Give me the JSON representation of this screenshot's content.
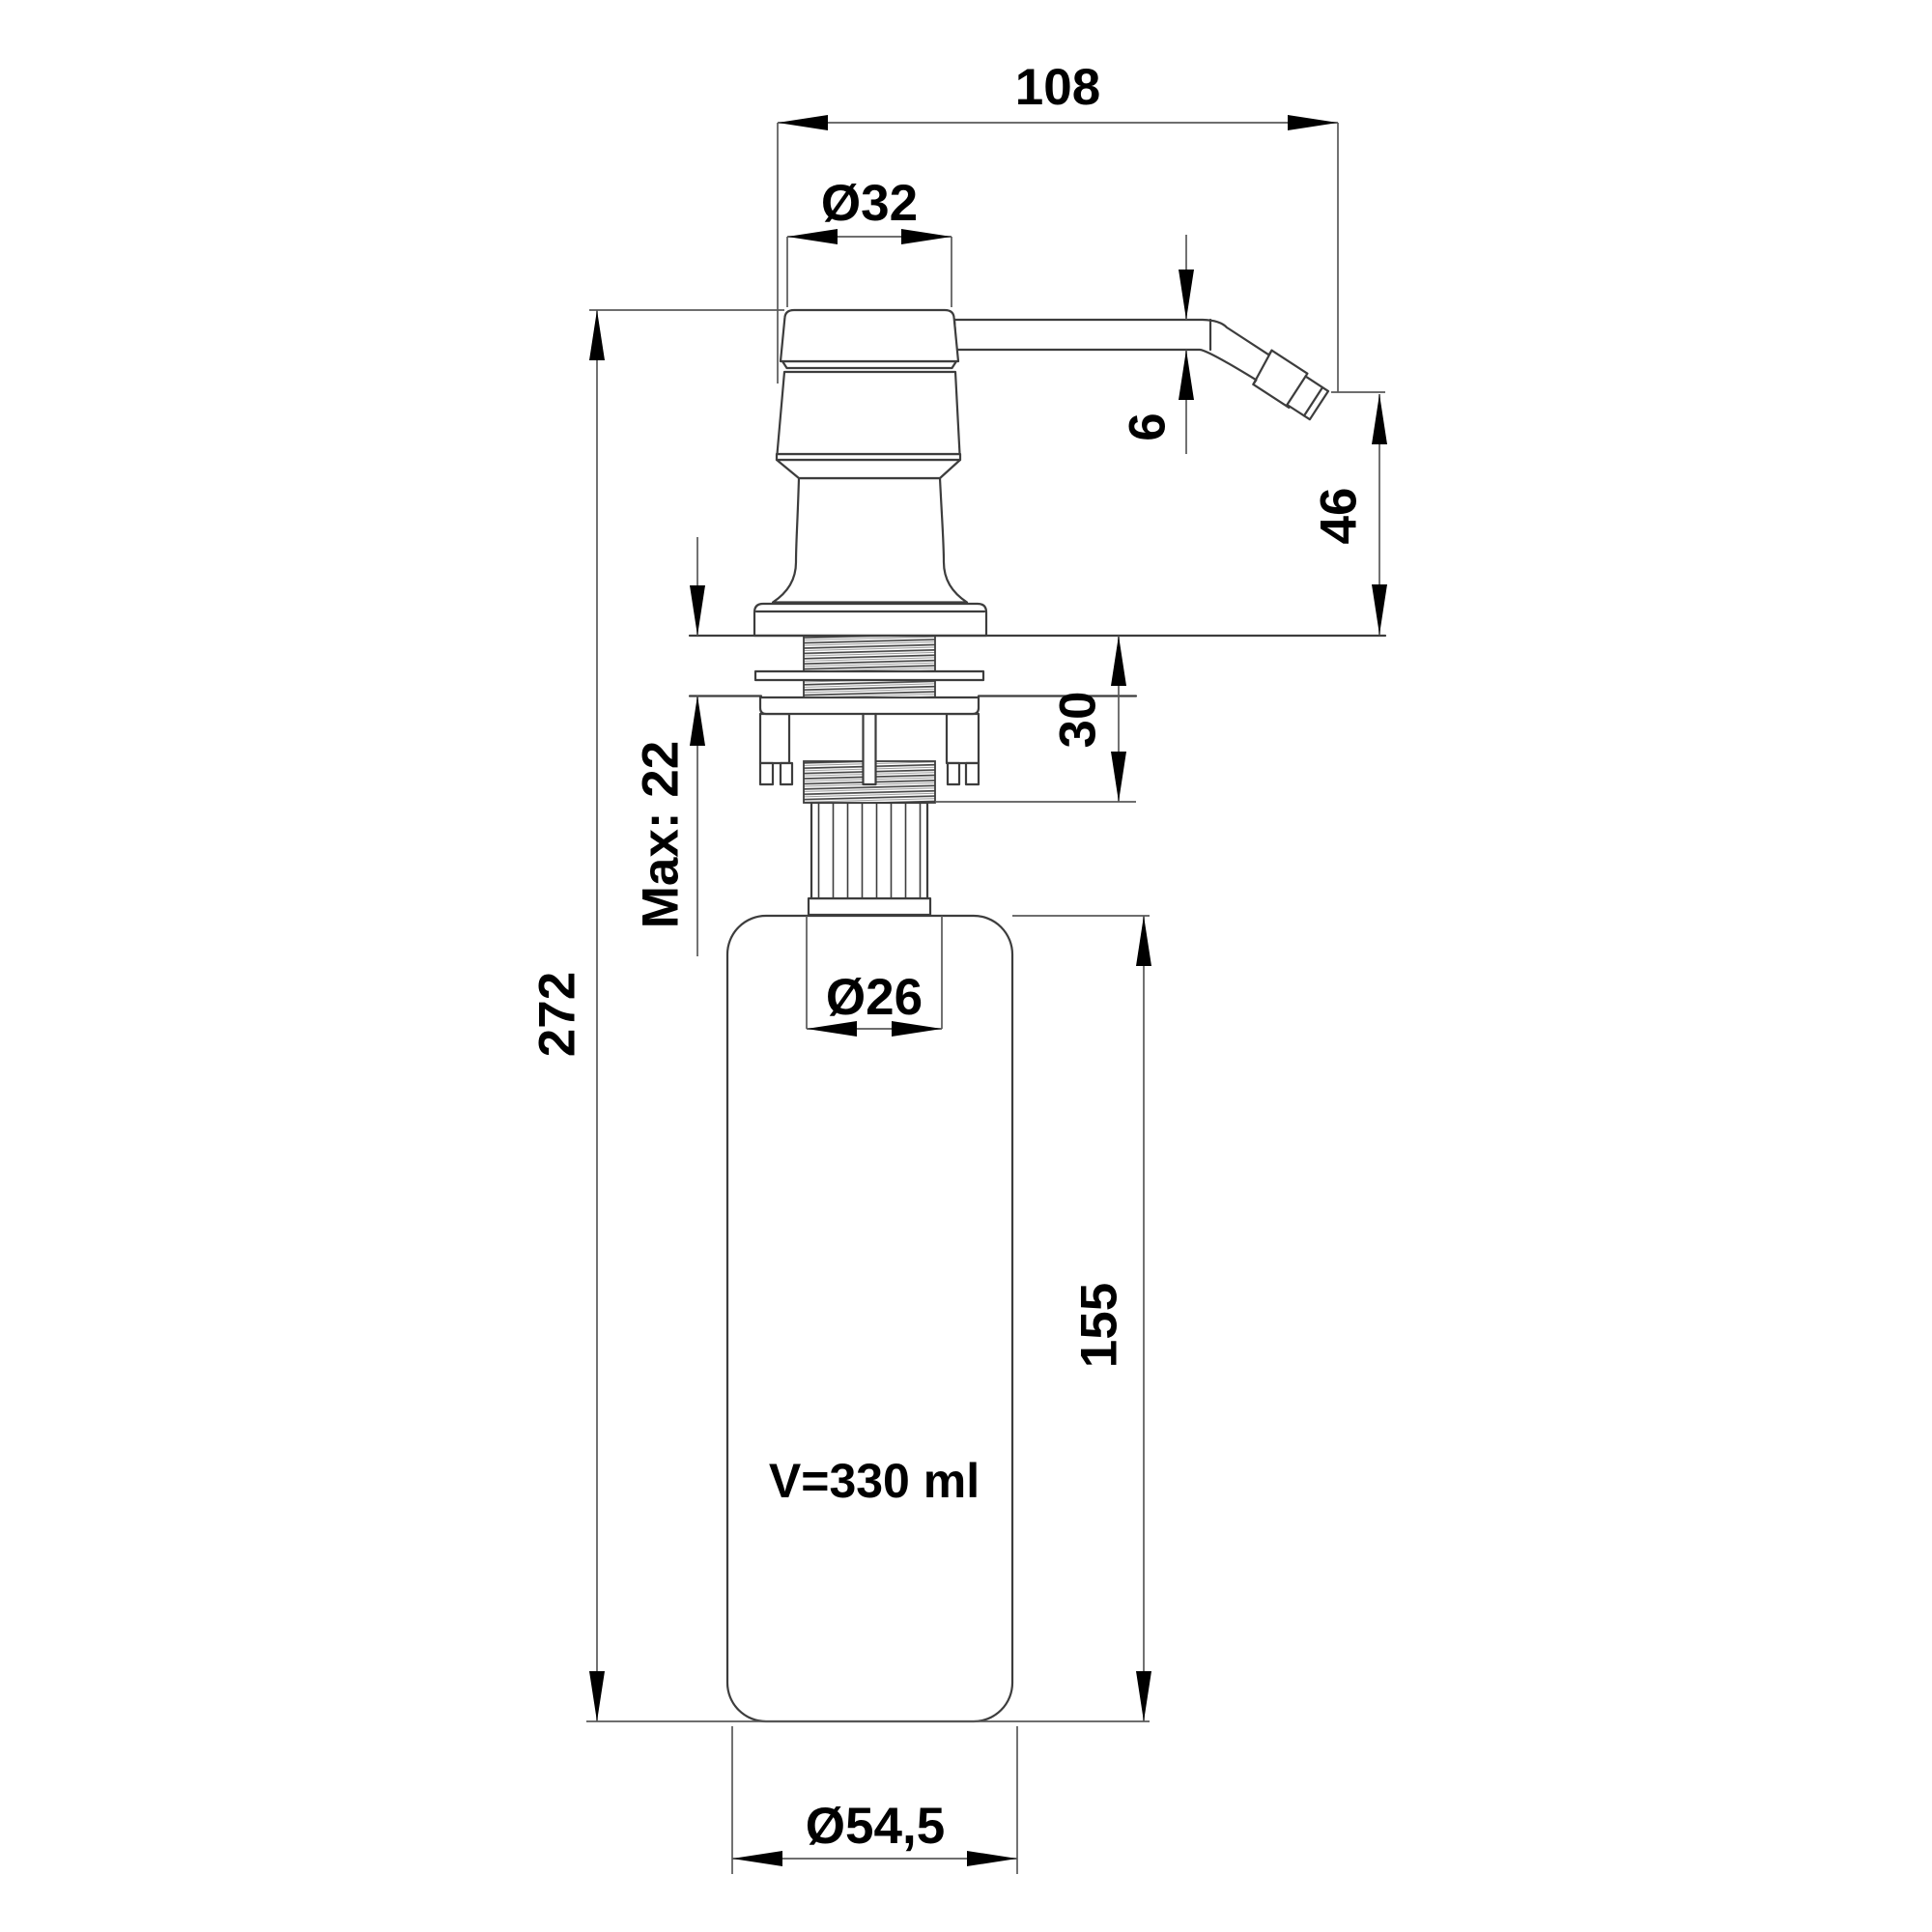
{
  "drawing": {
    "title": "Kitchen sink soap dispenser — dimensional drawing",
    "dims": {
      "spout_reach": "108",
      "head_diameter": "Ø32",
      "spout_tube_thickness": "6",
      "spout_height_above_counter": "46",
      "under_counter_depth": "30",
      "max_counter_thickness": "Max: 22",
      "total_height": "272",
      "neck_diameter": "Ø26",
      "bottle_body_height": "155",
      "bottle_diameter": "Ø54,5"
    },
    "annotations": {
      "volume": "V=330 ml"
    },
    "colors": {
      "background": "#ffffff",
      "object_line": "#3d3d3d",
      "dimension_line": "#5a5a5a",
      "ink": "#000000"
    }
  }
}
